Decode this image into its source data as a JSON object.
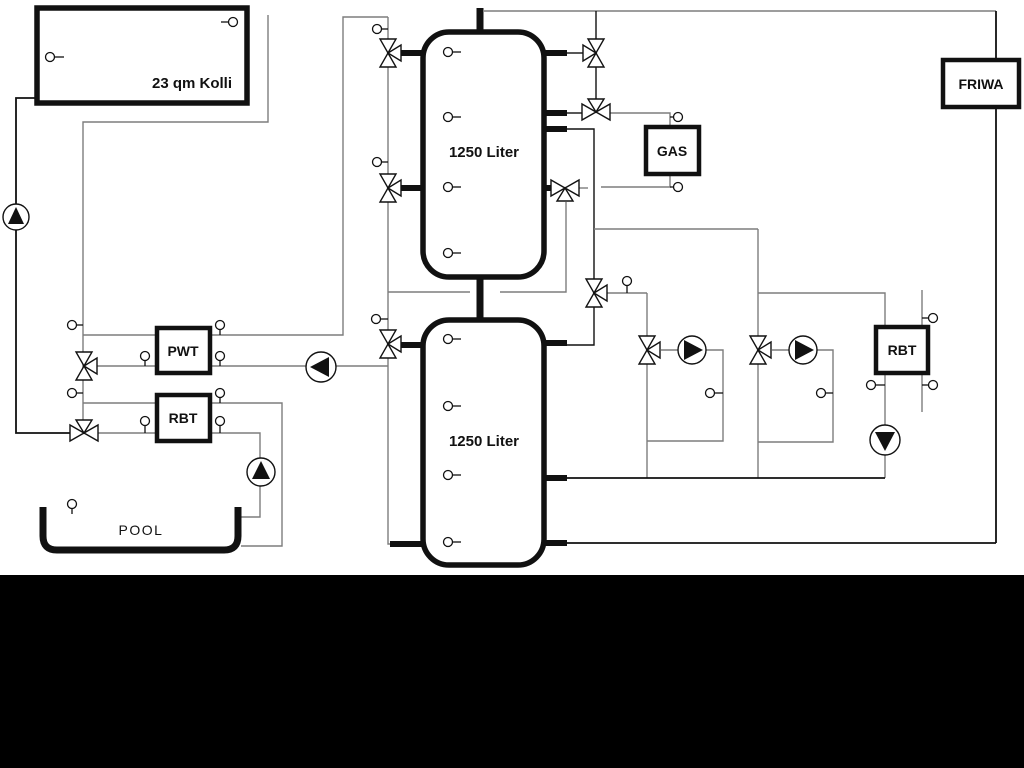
{
  "labels": {
    "collector": "23 qm Kolli",
    "upper_tank": "1250 Liter",
    "lower_tank": "1250 Liter",
    "gas": "GAS",
    "friwa": "FRIWA",
    "pwt": "PWT",
    "rbt_pool": "RBT",
    "rbt_heating": "RBT",
    "pool": "POOL"
  },
  "icons": {
    "pump": "pump-icon",
    "three_way_valve": "three-way-valve-icon",
    "sensor": "temperature-sensor-icon"
  },
  "colors": {
    "pipe_gray": "#7d7d7d",
    "pipe_black": "#111111",
    "background": "#ffffff",
    "bottom_bar": "#000000"
  }
}
